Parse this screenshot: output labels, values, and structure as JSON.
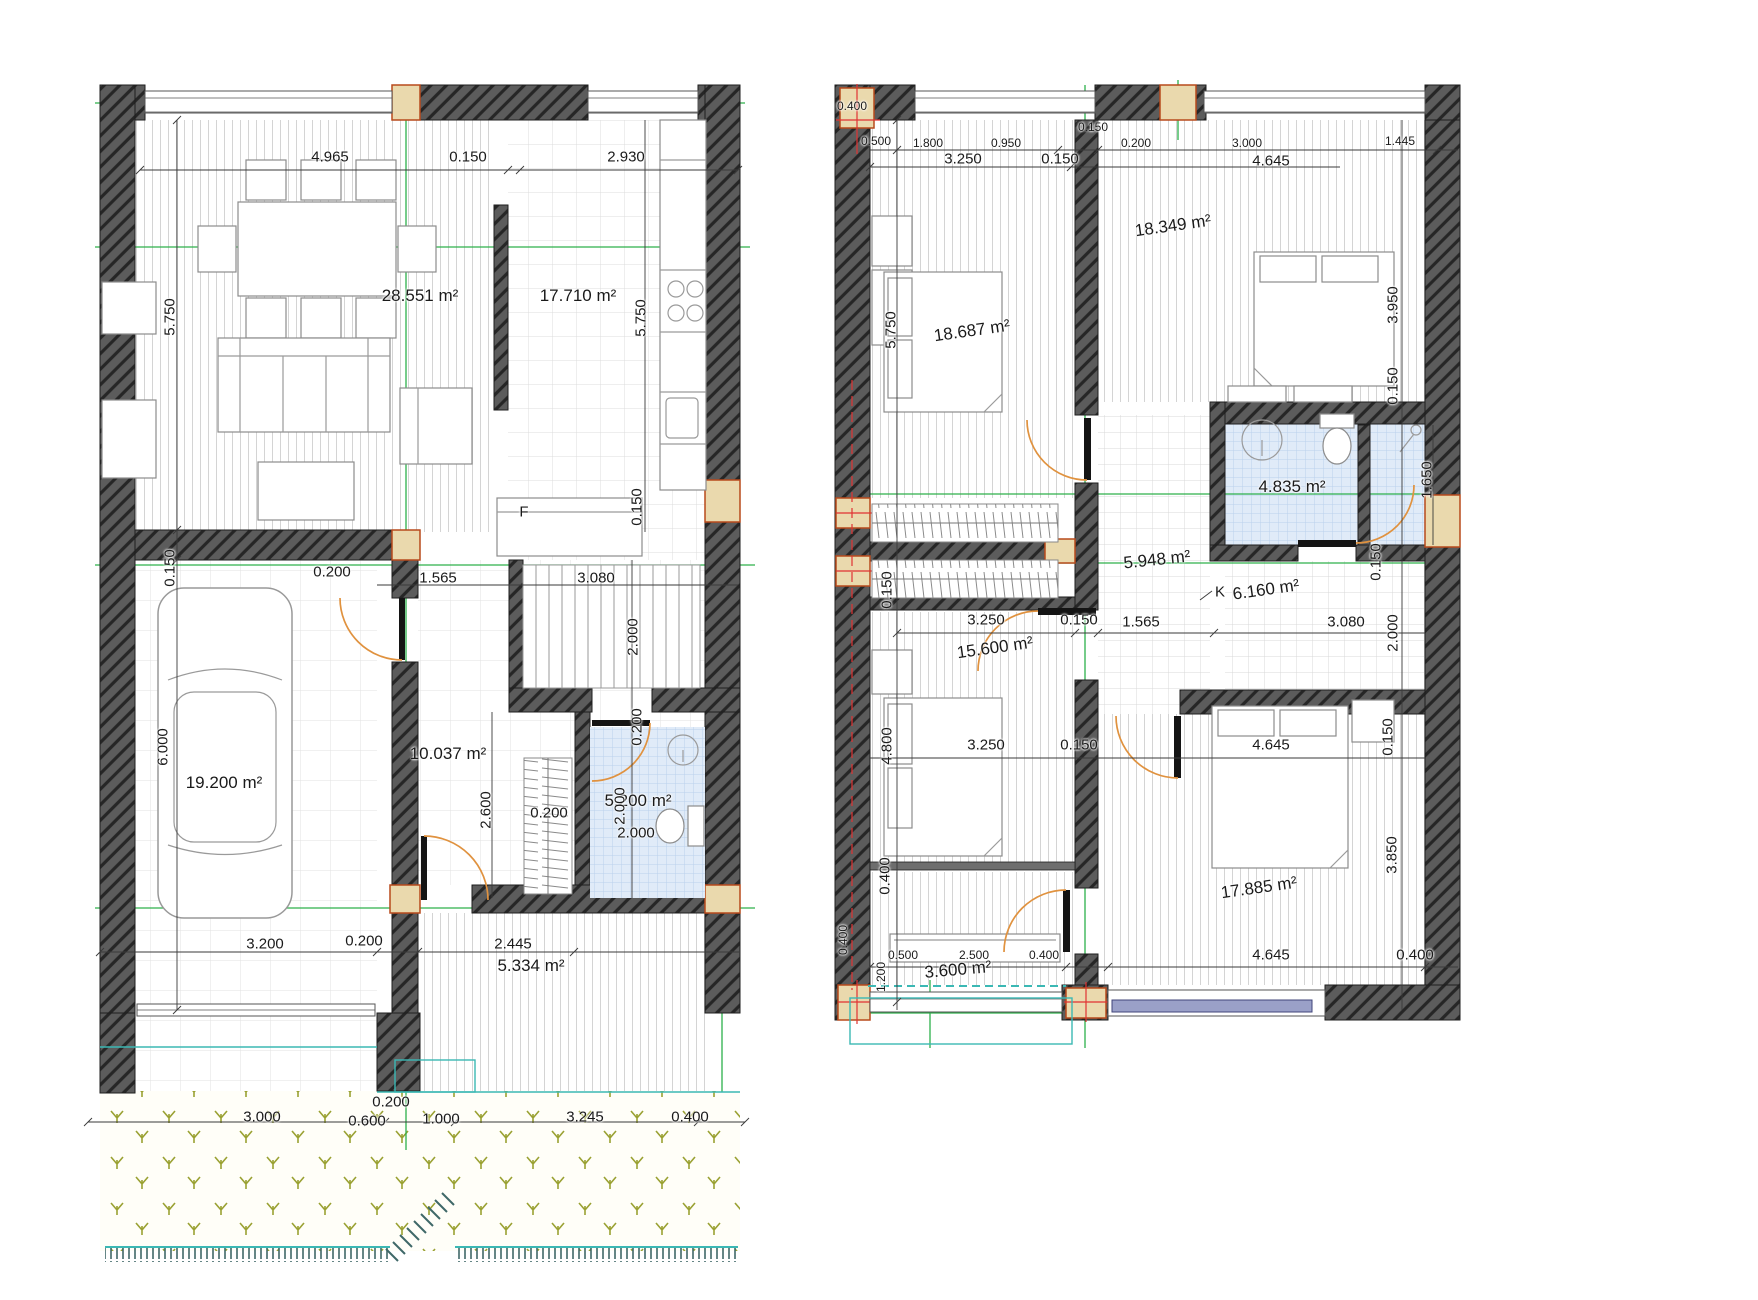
{
  "document": {
    "kind": "architectural floor plan drawing",
    "sheets": [
      "ground-floor",
      "upper-floor"
    ]
  },
  "colors": {
    "wall": "#5c5c5c",
    "wall_hatch": "#262626",
    "grid_axis_green": "#2db04b",
    "section_axis_red": "#e03333",
    "column_fill": "#ead9ad",
    "column_border": "#b84a1c",
    "door_swing": "#e0923f",
    "bath_tile": "#e0ebf8",
    "bath_tile_line": "#bad0ec",
    "garden_plant": "#9aa132",
    "fence_teal": "#3bb8b4",
    "dimension_text": "#1a1a1a"
  },
  "plans": [
    {
      "name": "ground-floor",
      "labels": [
        {
          "t": "4.965",
          "x": 330,
          "y": 157
        },
        {
          "t": "0.150",
          "x": 468,
          "y": 157
        },
        {
          "t": "2.930",
          "x": 626,
          "y": 157
        },
        {
          "t": "28.551 m²",
          "x": 420,
          "y": 296,
          "k": "area"
        },
        {
          "t": "17.710 m²",
          "x": 578,
          "y": 296,
          "k": "area"
        },
        {
          "t": "5.750",
          "x": 170,
          "y": 317,
          "r": -90
        },
        {
          "t": "5.750",
          "x": 641,
          "y": 318,
          "r": -90
        },
        {
          "t": "0.150",
          "x": 637,
          "y": 507,
          "r": -90
        },
        {
          "t": "F",
          "x": 524,
          "y": 512,
          "k": "ltr"
        },
        {
          "t": "0.150",
          "x": 170,
          "y": 568,
          "r": -90
        },
        {
          "t": "0.200",
          "x": 332,
          "y": 572
        },
        {
          "t": "1.565",
          "x": 438,
          "y": 578
        },
        {
          "t": "3.080",
          "x": 596,
          "y": 578
        },
        {
          "t": "2.000",
          "x": 633,
          "y": 637,
          "r": -90
        },
        {
          "t": "6.000",
          "x": 163,
          "y": 747,
          "r": -90
        },
        {
          "t": "19.200 m²",
          "x": 224,
          "y": 783,
          "k": "area"
        },
        {
          "t": "10.037 m²",
          "x": 448,
          "y": 754,
          "k": "area"
        },
        {
          "t": "0.200",
          "x": 637,
          "y": 727,
          "r": -90
        },
        {
          "t": "2.600",
          "x": 486,
          "y": 810,
          "r": -90
        },
        {
          "t": "0.200",
          "x": 549,
          "y": 813
        },
        {
          "t": "5.200 m²",
          "x": 638,
          "y": 801,
          "k": "area"
        },
        {
          "t": "2.000",
          "x": 620,
          "y": 806,
          "r": -90
        },
        {
          "t": "2.000",
          "x": 636,
          "y": 833
        },
        {
          "t": "3.200",
          "x": 265,
          "y": 944
        },
        {
          "t": "0.200",
          "x": 364,
          "y": 941
        },
        {
          "t": "2.445",
          "x": 513,
          "y": 944
        },
        {
          "t": "5.334 m²",
          "x": 531,
          "y": 966,
          "k": "area"
        },
        {
          "t": "3.000",
          "x": 262,
          "y": 1117
        },
        {
          "t": "0.200",
          "x": 391,
          "y": 1102
        },
        {
          "t": "0.600",
          "x": 367,
          "y": 1121
        },
        {
          "t": "1.000",
          "x": 441,
          "y": 1119
        },
        {
          "t": "3.245",
          "x": 585,
          "y": 1117
        },
        {
          "t": "0.400",
          "x": 690,
          "y": 1117
        }
      ]
    },
    {
      "name": "upper-floor",
      "labels": [
        {
          "t": "0.400",
          "x": 852,
          "y": 106,
          "k": "sm"
        },
        {
          "t": "0.500",
          "x": 876,
          "y": 141,
          "k": "sm"
        },
        {
          "t": "1.800",
          "x": 928,
          "y": 143,
          "k": "sm"
        },
        {
          "t": "0.950",
          "x": 1006,
          "y": 143,
          "k": "sm"
        },
        {
          "t": "0.150",
          "x": 1093,
          "y": 127,
          "k": "sm"
        },
        {
          "t": "0.200",
          "x": 1136,
          "y": 143,
          "k": "sm"
        },
        {
          "t": "3.000",
          "x": 1247,
          "y": 143,
          "k": "sm"
        },
        {
          "t": "1.445",
          "x": 1400,
          "y": 141,
          "k": "sm"
        },
        {
          "t": "3.250",
          "x": 963,
          "y": 159
        },
        {
          "t": "0.150",
          "x": 1060,
          "y": 159
        },
        {
          "t": "4.645",
          "x": 1271,
          "y": 161
        },
        {
          "t": "18.349 m²",
          "x": 1173,
          "y": 226,
          "k": "area",
          "r": -8
        },
        {
          "t": "5.750",
          "x": 891,
          "y": 330,
          "r": -90
        },
        {
          "t": "18.687 m²",
          "x": 972,
          "y": 331,
          "k": "area",
          "r": -8
        },
        {
          "t": "3.950",
          "x": 1393,
          "y": 305,
          "r": -90
        },
        {
          "t": "0.150",
          "x": 1393,
          "y": 386,
          "r": -90
        },
        {
          "t": "4.835 m²",
          "x": 1292,
          "y": 487,
          "k": "area"
        },
        {
          "t": "1.650",
          "x": 1427,
          "y": 480,
          "r": -90
        },
        {
          "t": "5.948 m²",
          "x": 1157,
          "y": 560,
          "k": "area",
          "r": -6
        },
        {
          "t": "0.150",
          "x": 887,
          "y": 590,
          "r": -90
        },
        {
          "t": "K",
          "x": 1220,
          "y": 592,
          "k": "ltr"
        },
        {
          "t": "6.160 m²",
          "x": 1266,
          "y": 590,
          "k": "area",
          "r": -8
        },
        {
          "t": "0.150",
          "x": 1376,
          "y": 562,
          "r": -90
        },
        {
          "t": "3.250",
          "x": 986,
          "y": 620
        },
        {
          "t": "0.150",
          "x": 1079,
          "y": 620
        },
        {
          "t": "1.565",
          "x": 1141,
          "y": 622
        },
        {
          "t": "3.080",
          "x": 1346,
          "y": 622
        },
        {
          "t": "2.000",
          "x": 1393,
          "y": 633,
          "r": -90
        },
        {
          "t": "15.600 m²",
          "x": 995,
          "y": 648,
          "k": "area",
          "r": -8
        },
        {
          "t": "4.800",
          "x": 887,
          "y": 746,
          "r": -90
        },
        {
          "t": "3.250",
          "x": 986,
          "y": 745
        },
        {
          "t": "0.150",
          "x": 1079,
          "y": 745
        },
        {
          "t": "4.645",
          "x": 1271,
          "y": 745
        },
        {
          "t": "0.150",
          "x": 1388,
          "y": 737,
          "r": -90
        },
        {
          "t": "0.400",
          "x": 885,
          "y": 876,
          "r": -90
        },
        {
          "t": "3.850",
          "x": 1392,
          "y": 855,
          "r": -90
        },
        {
          "t": "17.885 m²",
          "x": 1259,
          "y": 888,
          "k": "area",
          "r": -8
        },
        {
          "t": "1.200",
          "x": 881,
          "y": 977,
          "r": -90,
          "k": "sm"
        },
        {
          "t": "3.600 m²",
          "x": 958,
          "y": 970,
          "k": "area",
          "r": -5
        },
        {
          "t": "0.500",
          "x": 903,
          "y": 955,
          "k": "sm"
        },
        {
          "t": "2.500",
          "x": 974,
          "y": 955,
          "k": "sm"
        },
        {
          "t": "0.400",
          "x": 1044,
          "y": 955,
          "k": "sm"
        },
        {
          "t": "4.645",
          "x": 1271,
          "y": 955
        },
        {
          "t": "0.400",
          "x": 1415,
          "y": 955
        },
        {
          "t": "0.400",
          "x": 843,
          "y": 940,
          "r": -90,
          "k": "sm"
        }
      ]
    }
  ]
}
